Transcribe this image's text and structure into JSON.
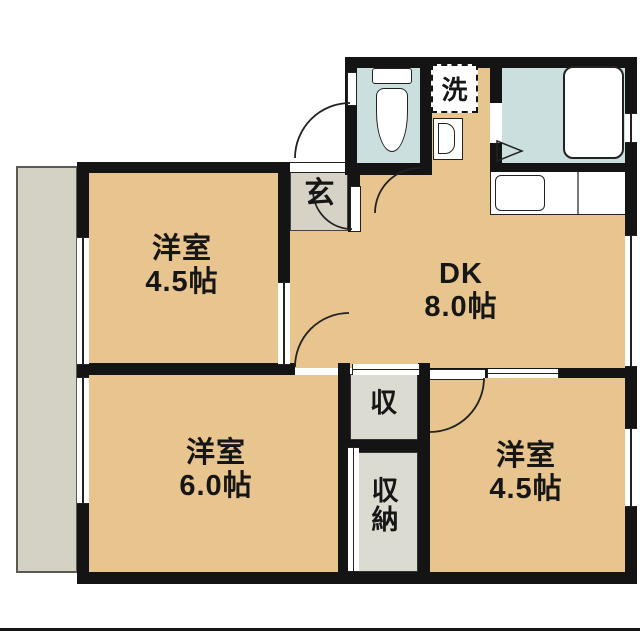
{
  "floorplan": {
    "rooms": [
      {
        "id": "western-room-nw",
        "name": "洋室",
        "area": "4.5帖"
      },
      {
        "id": "dining-kitchen",
        "name": "DK",
        "area": "8.0帖"
      },
      {
        "id": "western-room-sw",
        "name": "洋室",
        "area": "6.0帖"
      },
      {
        "id": "western-room-se",
        "name": "洋室",
        "area": "4.5帖"
      }
    ],
    "labels": {
      "entrance": "玄",
      "washer": "洗",
      "closet": "収",
      "storage": "収納"
    },
    "colors": {
      "room_floor": "#e8c48e",
      "wet_area": "#cbe0de",
      "balcony": "#d4d2c4",
      "entrance_floor": "#d6d3c6",
      "closet": "#dcdbd1",
      "wall": "#141414"
    }
  }
}
